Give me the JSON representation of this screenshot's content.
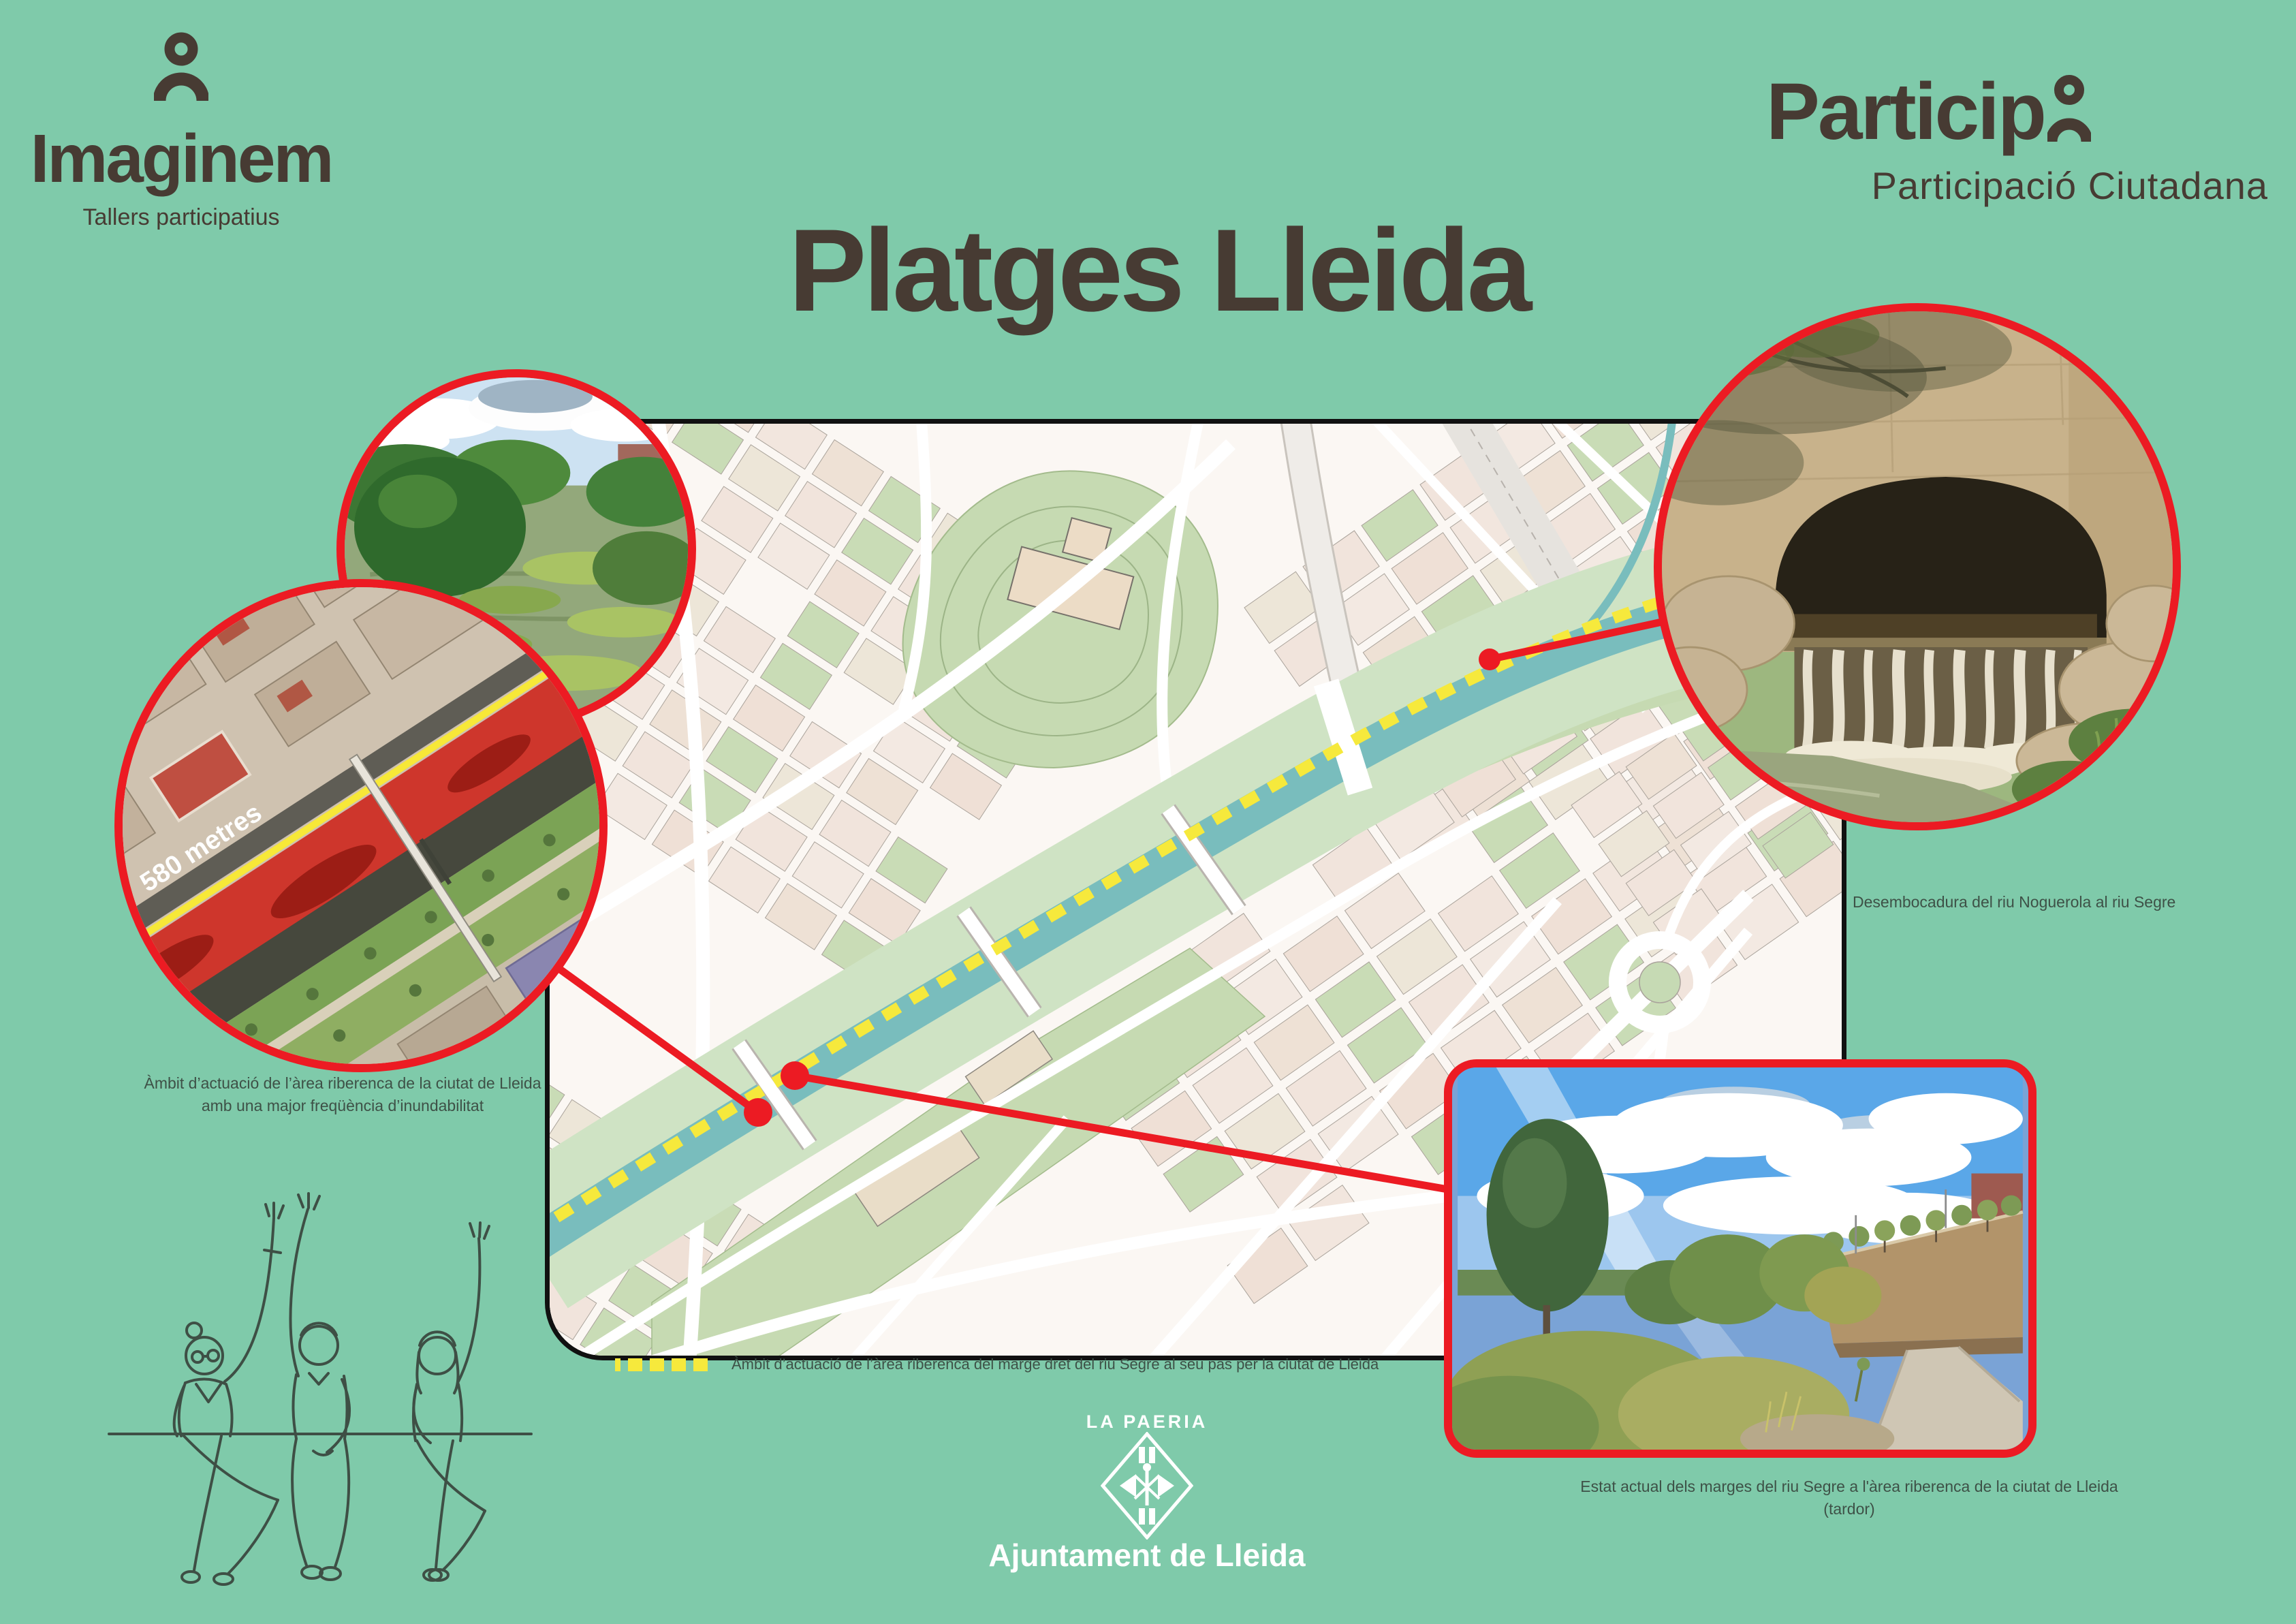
{
  "brand_left": {
    "name": "Imaginem",
    "tagline": "Tallers participatius"
  },
  "brand_right": {
    "word": "Particip",
    "subtitle": "Participació Ciutadana"
  },
  "title": "Platges Lleida",
  "map": {
    "legend_label": "Àmbit d’actuació de l’àrea riberenca del marge dret del riu Segre al seu pas per la ciutat de Lleida"
  },
  "insets": {
    "aerial": {
      "distance_label": "580 metres",
      "caption_line1": "Àmbit d’actuació de l’àrea riberenca de la ciutat de Lleida",
      "caption_line2": "amb una major freqüència d’inundabilitat"
    },
    "tunnel": {
      "caption": "Desembocadura del riu Noguerola al riu Segre"
    },
    "autumn": {
      "caption_line1": "Estat actual dels marges del riu Segre a l'àrea riberenca de la ciutat de Lleida",
      "caption_line2": "(tardor)"
    }
  },
  "footer": {
    "org_header": "LA PAERIA",
    "org_name": "Ajuntament de Lleida"
  },
  "colors": {
    "background": "#7FCAAA",
    "ink": "#473B33",
    "caption": "#3E5147",
    "accent_red": "#EC1B23",
    "accent_yellow": "#F6E93C",
    "river": "#79BDBD",
    "map_green": "#C6DAB2",
    "white": "#FFFFFF"
  }
}
